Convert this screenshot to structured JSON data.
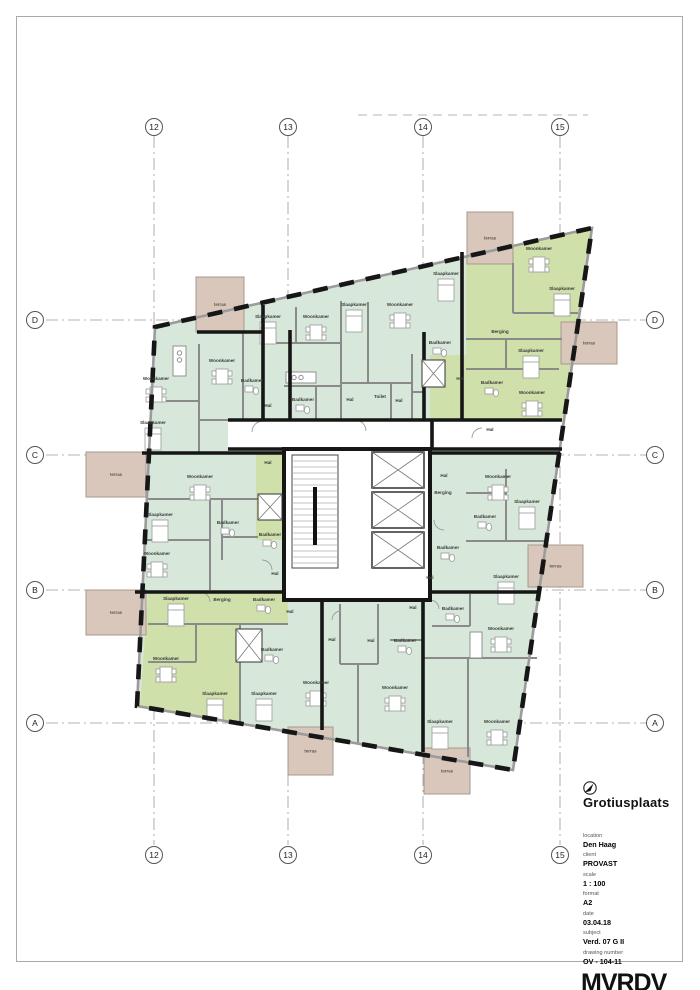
{
  "sheet": {
    "title": "Grotiusplaats",
    "fields": [
      {
        "label": "location",
        "value": "Den Haag"
      },
      {
        "label": "client",
        "value": "PROVAST"
      },
      {
        "label": "scale",
        "value": "1 : 100"
      },
      {
        "label": "format",
        "value": "A2"
      },
      {
        "label": "date",
        "value": "03.04.18"
      },
      {
        "label": "subject",
        "value": "Verd. 07 G II"
      },
      {
        "label": "drawing number",
        "value": "OV - 104-11"
      }
    ],
    "logo": "MVRDV",
    "address_line1": "Achterklooster 7 - 3011 RA - Rotterdam",
    "address_line2": "+31 (0)10 477 28 60 - www.mvrdv.com"
  },
  "grid": {
    "cols": [
      {
        "label": "12",
        "x": 154
      },
      {
        "label": "13",
        "x": 288
      },
      {
        "label": "14",
        "x": 423
      },
      {
        "label": "15",
        "x": 560
      }
    ],
    "rows": [
      {
        "label": "D",
        "y": 320
      },
      {
        "label": "C",
        "y": 455
      },
      {
        "label": "B",
        "y": 590
      },
      {
        "label": "A",
        "y": 723
      }
    ]
  },
  "plan": {
    "colors": {
      "apartment_mint": "#d7e8db",
      "apartment_green": "#cfe0aa",
      "terrace_beige": "#d8c7ba",
      "wall_black": "#161616",
      "wall_gray": "#8a8a8a",
      "grid_gray": "#9a9a9a"
    },
    "terraces": [
      {
        "label": "terras",
        "x": 196,
        "y": 277,
        "w": 48,
        "h": 55
      },
      {
        "label": "terras",
        "x": 467,
        "y": 212,
        "w": 46,
        "h": 52
      },
      {
        "label": "terras",
        "x": 561,
        "y": 322,
        "w": 56,
        "h": 42
      },
      {
        "label": "terras",
        "x": 86,
        "y": 452,
        "w": 60,
        "h": 45
      },
      {
        "label": "terras",
        "x": 86,
        "y": 590,
        "w": 60,
        "h": 45
      },
      {
        "label": "terras",
        "x": 528,
        "y": 545,
        "w": 55,
        "h": 42
      },
      {
        "label": "terras",
        "x": 288,
        "y": 727,
        "w": 45,
        "h": 48
      },
      {
        "label": "terras",
        "x": 424,
        "y": 748,
        "w": 46,
        "h": 46
      }
    ],
    "rooms": [
      {
        "label": "Woonkamer",
        "x": 156,
        "y": 380
      },
      {
        "label": "Slaapkamer",
        "x": 153,
        "y": 424
      },
      {
        "label": "Woonkamer",
        "x": 222,
        "y": 362
      },
      {
        "label": "Slaapkamer",
        "x": 268,
        "y": 318
      },
      {
        "label": "Woonkamer",
        "x": 316,
        "y": 318
      },
      {
        "label": "Badkamer",
        "x": 252,
        "y": 382
      },
      {
        "label": "Badkamer",
        "x": 303,
        "y": 401
      },
      {
        "label": "Hal",
        "x": 268,
        "y": 407
      },
      {
        "label": "Slaapkamer",
        "x": 354,
        "y": 306
      },
      {
        "label": "Woonkamer",
        "x": 400,
        "y": 306
      },
      {
        "label": "Hal",
        "x": 350,
        "y": 401
      },
      {
        "label": "Toilet",
        "x": 380,
        "y": 398
      },
      {
        "label": "Hal",
        "x": 399,
        "y": 402
      },
      {
        "label": "Badkamer",
        "x": 440,
        "y": 344
      },
      {
        "label": "Slaapkamer",
        "x": 446,
        "y": 275
      },
      {
        "label": "Woonkamer",
        "x": 539,
        "y": 250
      },
      {
        "label": "Slaapkamer",
        "x": 562,
        "y": 290
      },
      {
        "label": "Berging",
        "x": 500,
        "y": 333
      },
      {
        "label": "Slaapkamer",
        "x": 531,
        "y": 352
      },
      {
        "label": "Hal",
        "x": 460,
        "y": 380
      },
      {
        "label": "Badkamer",
        "x": 492,
        "y": 384
      },
      {
        "label": "Woonkamer",
        "x": 532,
        "y": 394
      },
      {
        "label": "Hal",
        "x": 490,
        "y": 431
      },
      {
        "label": "Woonkamer",
        "x": 200,
        "y": 478
      },
      {
        "label": "Slaapkamer",
        "x": 160,
        "y": 516
      },
      {
        "label": "Badkamer",
        "x": 228,
        "y": 524
      },
      {
        "label": "Woonkamer",
        "x": 157,
        "y": 555
      },
      {
        "label": "Hal",
        "x": 268,
        "y": 464
      },
      {
        "label": "Badkamer",
        "x": 270,
        "y": 536
      },
      {
        "label": "Hal",
        "x": 275,
        "y": 575
      },
      {
        "label": "Berging",
        "x": 443,
        "y": 494
      },
      {
        "label": "Hal",
        "x": 444,
        "y": 477
      },
      {
        "label": "Badkamer",
        "x": 448,
        "y": 549
      },
      {
        "label": "Hal",
        "x": 430,
        "y": 579
      },
      {
        "label": "Woonkamer",
        "x": 498,
        "y": 478
      },
      {
        "label": "Slaapkamer",
        "x": 527,
        "y": 503
      },
      {
        "label": "Badkamer",
        "x": 485,
        "y": 518
      },
      {
        "label": "Slaapkamer",
        "x": 506,
        "y": 578
      },
      {
        "label": "Slaapkamer",
        "x": 176,
        "y": 600
      },
      {
        "label": "Berging",
        "x": 222,
        "y": 601
      },
      {
        "label": "Badkamer",
        "x": 264,
        "y": 601
      },
      {
        "label": "Hal",
        "x": 290,
        "y": 613
      },
      {
        "label": "Woonkamer",
        "x": 166,
        "y": 660
      },
      {
        "label": "Slaapkamer",
        "x": 215,
        "y": 695
      },
      {
        "label": "Slaapkamer",
        "x": 264,
        "y": 695
      },
      {
        "label": "Badkamer",
        "x": 272,
        "y": 651
      },
      {
        "label": "Hal",
        "x": 332,
        "y": 641
      },
      {
        "label": "Hal",
        "x": 371,
        "y": 642
      },
      {
        "label": "Badkamer",
        "x": 405,
        "y": 642
      },
      {
        "label": "Woonkamer",
        "x": 316,
        "y": 684
      },
      {
        "label": "Woonkamer",
        "x": 395,
        "y": 689
      },
      {
        "label": "Hal",
        "x": 413,
        "y": 609
      },
      {
        "label": "Badkamer",
        "x": 453,
        "y": 610
      },
      {
        "label": "Woonkamer",
        "x": 501,
        "y": 630
      },
      {
        "label": "Slaapkamer",
        "x": 440,
        "y": 723
      },
      {
        "label": "Woonkamer",
        "x": 497,
        "y": 723
      }
    ]
  }
}
